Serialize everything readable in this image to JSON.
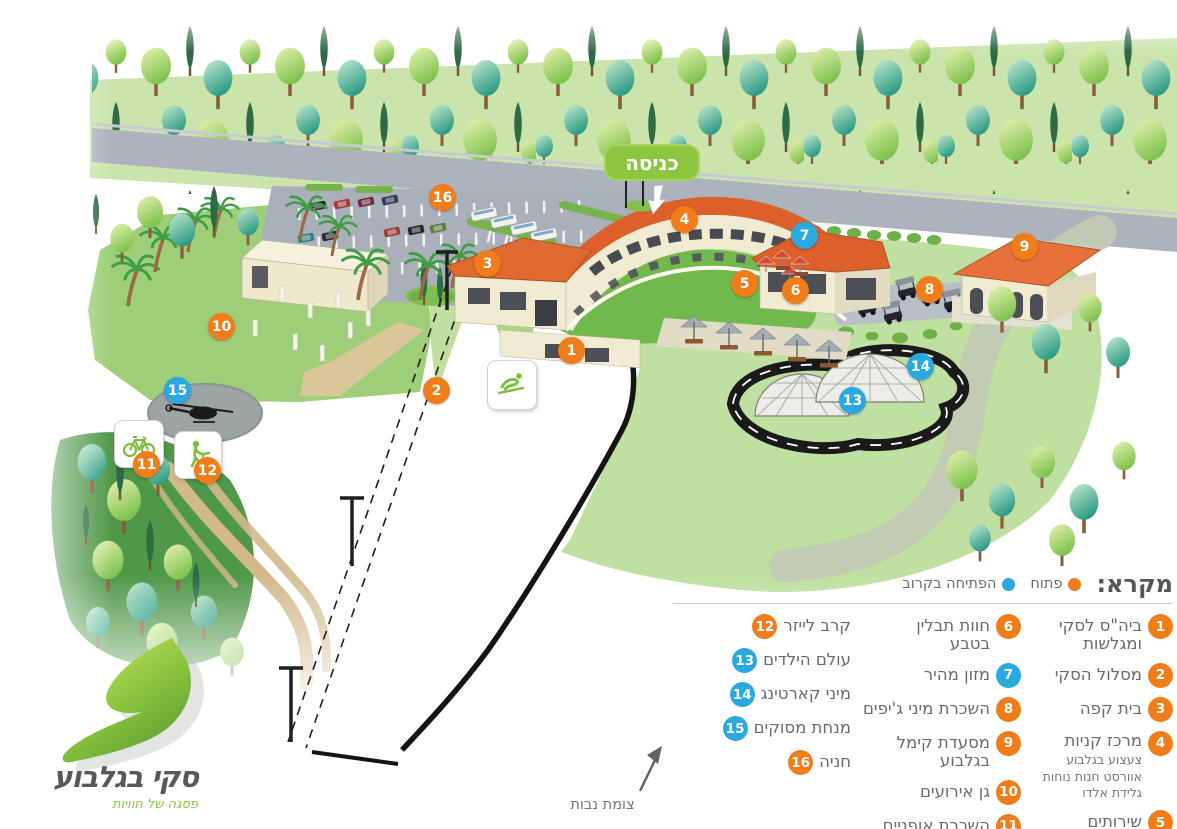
{
  "colors": {
    "open": "#F07D1A",
    "soon": "#29A9E0",
    "entrance_green": "#8CC63F"
  },
  "logo": {
    "name": "סקי בגלבוע",
    "tagline": "פסגה של חוויות"
  },
  "entrance_sign": {
    "label": "כניסה"
  },
  "junction": {
    "label": "צומת נבות"
  },
  "legend": {
    "title": "מקרא:",
    "statuses": [
      {
        "id": "open",
        "label": "פתוח"
      },
      {
        "id": "soon",
        "label": "הפתיחה בקרוב"
      }
    ],
    "columns": [
      {
        "items": [
          {
            "num": "1",
            "status": "open",
            "label": "ביה\"ס לסקי\nומגלשות"
          },
          {
            "num": "2",
            "status": "open",
            "label": "מסלול הסקי"
          },
          {
            "num": "3",
            "status": "open",
            "label": "בית קפה"
          },
          {
            "num": "4",
            "status": "open",
            "label": "מרכז קניות",
            "sub": "צעצוע בגלבוע\nאוורסט חנות נוחות\nגלידת אלדו"
          },
          {
            "num": "5",
            "status": "open",
            "label": "שירותים"
          }
        ]
      },
      {
        "items": [
          {
            "num": "6",
            "status": "open",
            "label": "חוות תבלין\nבטבע"
          },
          {
            "num": "7",
            "status": "soon",
            "label": "מזון מהיר"
          },
          {
            "num": "8",
            "status": "open",
            "label": "השכרת מיני ג'יפים"
          },
          {
            "num": "9",
            "status": "open",
            "label": "מסעדת קימל\nבגלבוע"
          },
          {
            "num": "10",
            "status": "open",
            "label": "גן אירועים"
          },
          {
            "num": "11",
            "status": "open",
            "label": "השכרת אופניים"
          }
        ]
      },
      {
        "items": [
          {
            "num": "12",
            "status": "open",
            "label": "קרב לייזר"
          },
          {
            "num": "13",
            "status": "soon",
            "label": "עולם הילדים"
          },
          {
            "num": "14",
            "status": "soon",
            "label": "מיני קארטינג"
          },
          {
            "num": "15",
            "status": "soon",
            "label": "מנחת מסוקים"
          },
          {
            "num": "16",
            "status": "open",
            "label": "חניה"
          }
        ]
      }
    ]
  },
  "map_markers": [
    {
      "num": "1",
      "status": "open"
    },
    {
      "num": "2",
      "status": "open"
    },
    {
      "num": "3",
      "status": "open"
    },
    {
      "num": "4",
      "status": "open"
    },
    {
      "num": "5",
      "status": "open"
    },
    {
      "num": "6",
      "status": "open"
    },
    {
      "num": "7",
      "status": "soon"
    },
    {
      "num": "8",
      "status": "open"
    },
    {
      "num": "9",
      "status": "open"
    },
    {
      "num": "10",
      "status": "open"
    },
    {
      "num": "11",
      "status": "open"
    },
    {
      "num": "12",
      "status": "open"
    },
    {
      "num": "13",
      "status": "soon"
    },
    {
      "num": "14",
      "status": "soon"
    },
    {
      "num": "15",
      "status": "soon"
    },
    {
      "num": "16",
      "status": "open"
    }
  ]
}
